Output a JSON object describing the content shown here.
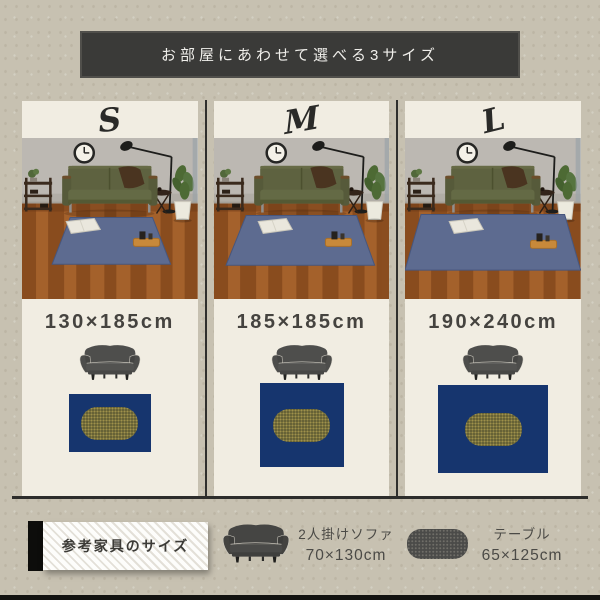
{
  "banner": {
    "text": "お部屋にあわせて選べる3サイズ",
    "bg": "#3a3a38",
    "text_color": "#f0efeb"
  },
  "sizes": [
    {
      "letter": "S",
      "dimensions": "130×185cm",
      "rug_css": "width:82px;height:58px;margin-top:12px",
      "photo_rug_points": "48,80 130,80 148,127 30,127"
    },
    {
      "letter": "M",
      "dimensions": "185×185cm",
      "rug_css": "width:84px;height:84px;margin-top:1px",
      "photo_rug_points": "32,78 142,78 160,128 12,128"
    },
    {
      "letter": "L",
      "dimensions": "190×240cm",
      "rug_css": "width:110px;height:88px;margin-top:3px",
      "photo_rug_points": "16,77 159,77 175,133 0,133"
    }
  ],
  "legend": {
    "title": "参考家具のサイズ",
    "sofa_name": "2人掛けソファ",
    "sofa_size": "70×130cm",
    "table_name": "テーブル",
    "table_size": "65×125cm"
  },
  "icons": {
    "sofa": "2-seater-sofa-silhouette",
    "table": "rounded-oval-table-silhouette",
    "clock": "wall-clock",
    "lamp": "floor-lamp",
    "plant": "potted-plant",
    "shelf": "console-shelf",
    "pillow": "cushion",
    "tray": "wooden-tray"
  },
  "colors": {
    "background": "#c7c1b1",
    "panel": "#f1ede2",
    "banner_bg": "#3a3a38",
    "rug_navy": "#16356e",
    "table_olive": "#5f5c33",
    "photo_rug_denim": "#5d6b90",
    "sofa_gray": "#4e4e4c"
  }
}
